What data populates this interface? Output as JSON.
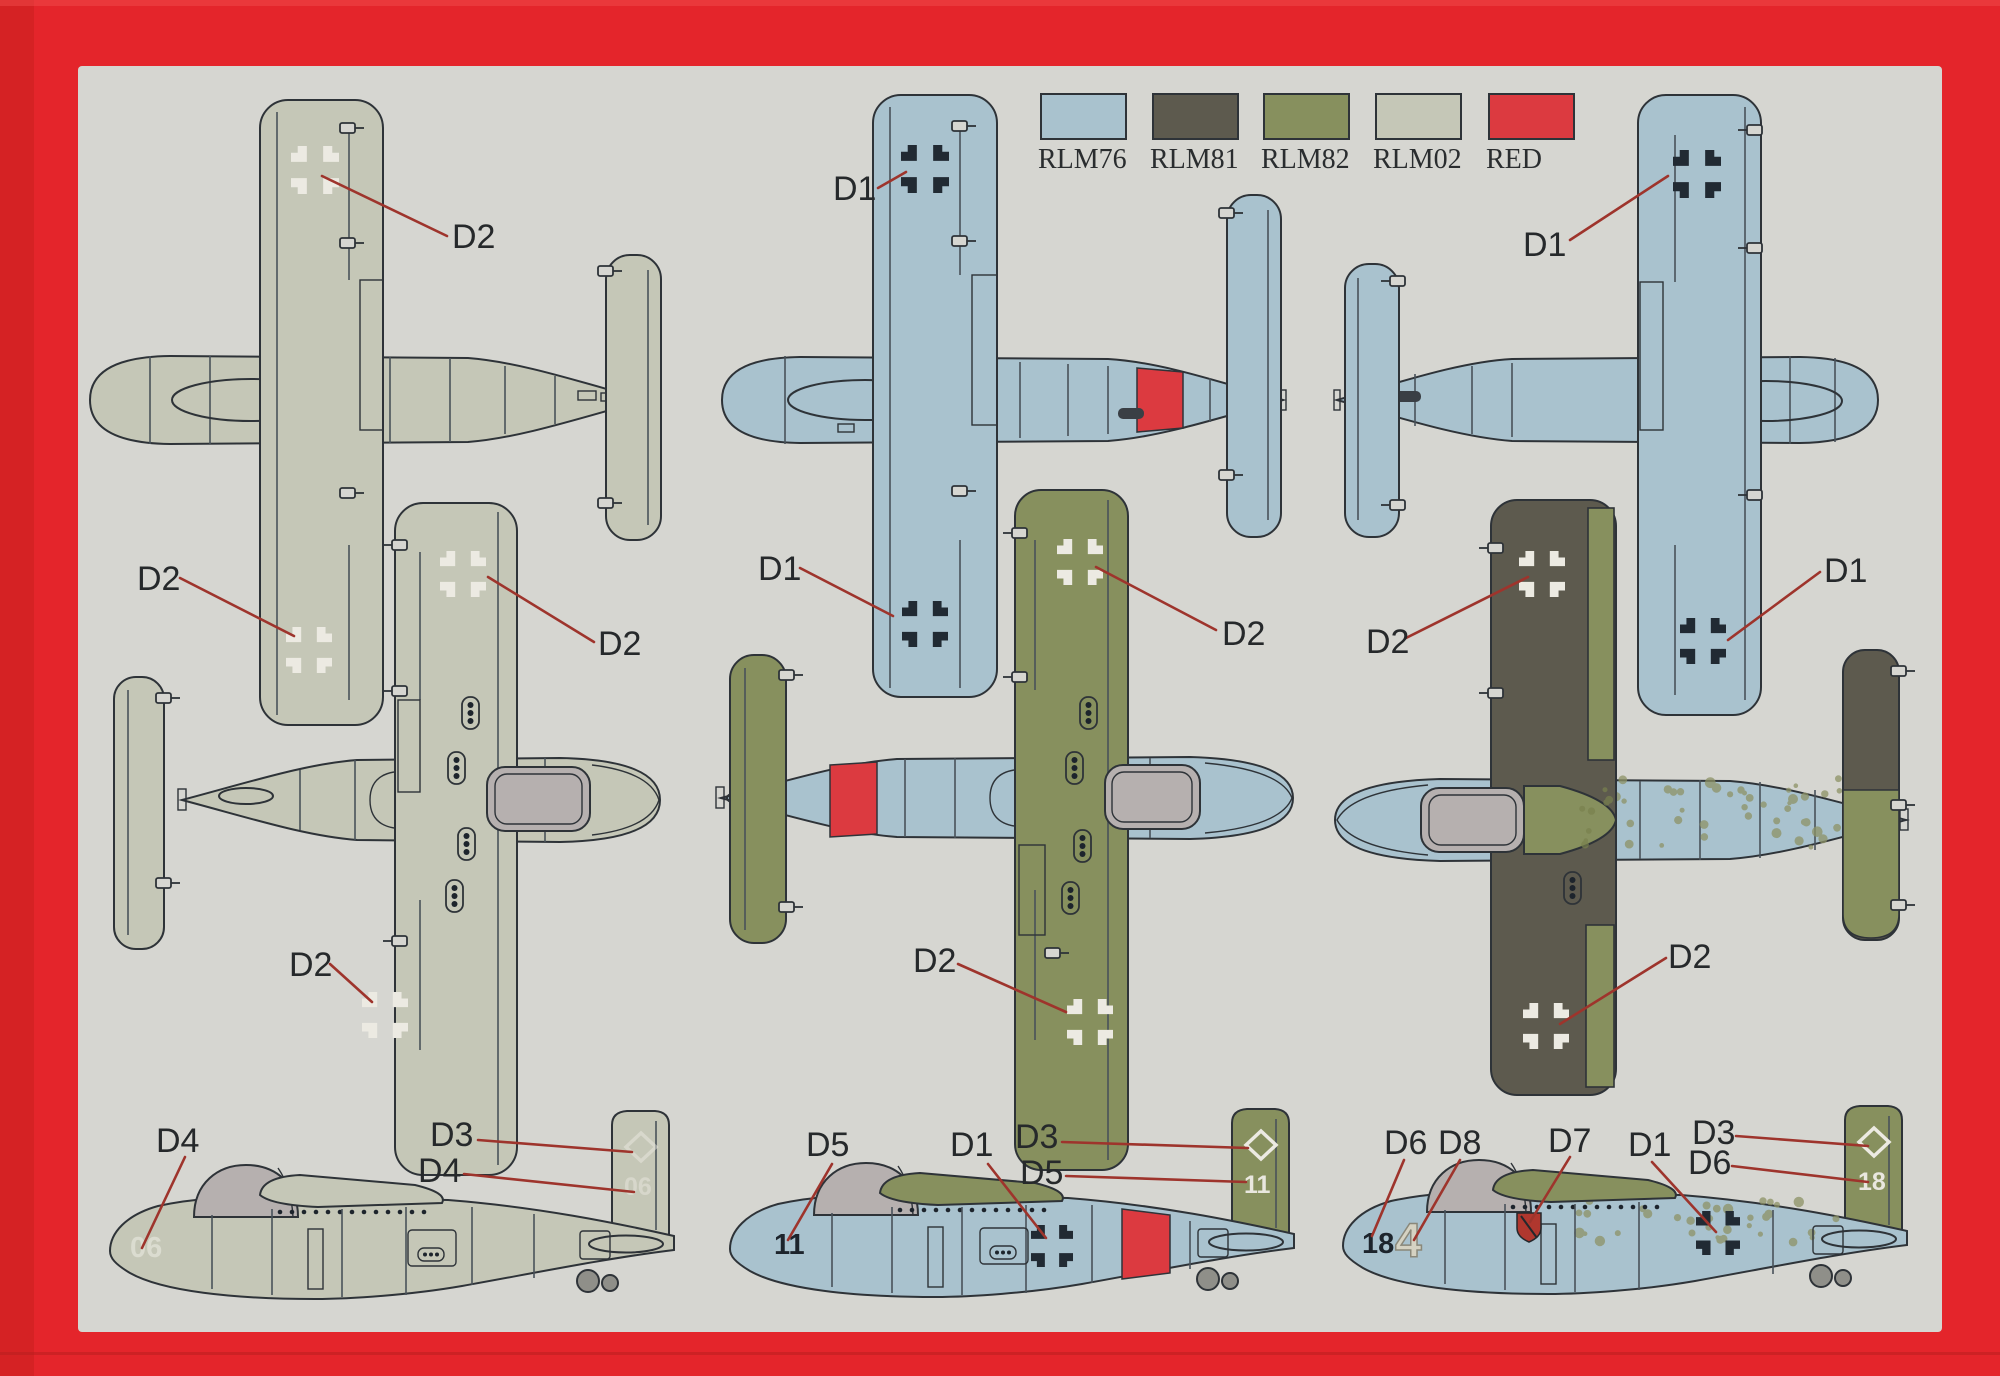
{
  "colors": {
    "rlm76": "#a9c2ce",
    "rlm81": "#5d5a4e",
    "rlm82": "#87905e",
    "rlm02": "#c5c7b7",
    "red": "#dc3a40",
    "frame_red": "#e4252b",
    "frame_red_shade": "#c9201f",
    "paper": "#d6d6d1",
    "leader_line": "#9e342c"
  },
  "legend": {
    "items": [
      {
        "label": "RLM76",
        "color": "#a9c2ce"
      },
      {
        "label": "RLM81",
        "color": "#5d5a4e"
      },
      {
        "label": "RLM82",
        "color": "#87905e"
      },
      {
        "label": "RLM02",
        "color": "#c5c7b7"
      },
      {
        "label": "RED",
        "color": "#dc3a40"
      }
    ]
  },
  "callouts": [
    {
      "label": "D2"
    },
    {
      "label": "D2"
    },
    {
      "label": "D2"
    },
    {
      "label": "D2"
    },
    {
      "label": "D2"
    },
    {
      "label": "D1"
    },
    {
      "label": "D1"
    },
    {
      "label": "D2"
    },
    {
      "label": "D1"
    },
    {
      "label": "D2"
    },
    {
      "label": "D1"
    },
    {
      "label": "D2"
    },
    {
      "label": "D4"
    },
    {
      "label": "D3"
    },
    {
      "label": "D4"
    },
    {
      "label": "D5"
    },
    {
      "label": "D1"
    },
    {
      "label": "D3"
    },
    {
      "label": "D5"
    },
    {
      "label": "D6"
    },
    {
      "label": "D8"
    },
    {
      "label": "D7"
    },
    {
      "label": "D1"
    },
    {
      "label": "D3"
    },
    {
      "label": "D6"
    }
  ],
  "markings": {
    "scheme1_nose": "06",
    "scheme1_fin": "06",
    "scheme2_nose": "11",
    "scheme2_fin": "11",
    "scheme3_nose": "18",
    "scheme3_fin": "18",
    "scheme3_number": "4"
  }
}
